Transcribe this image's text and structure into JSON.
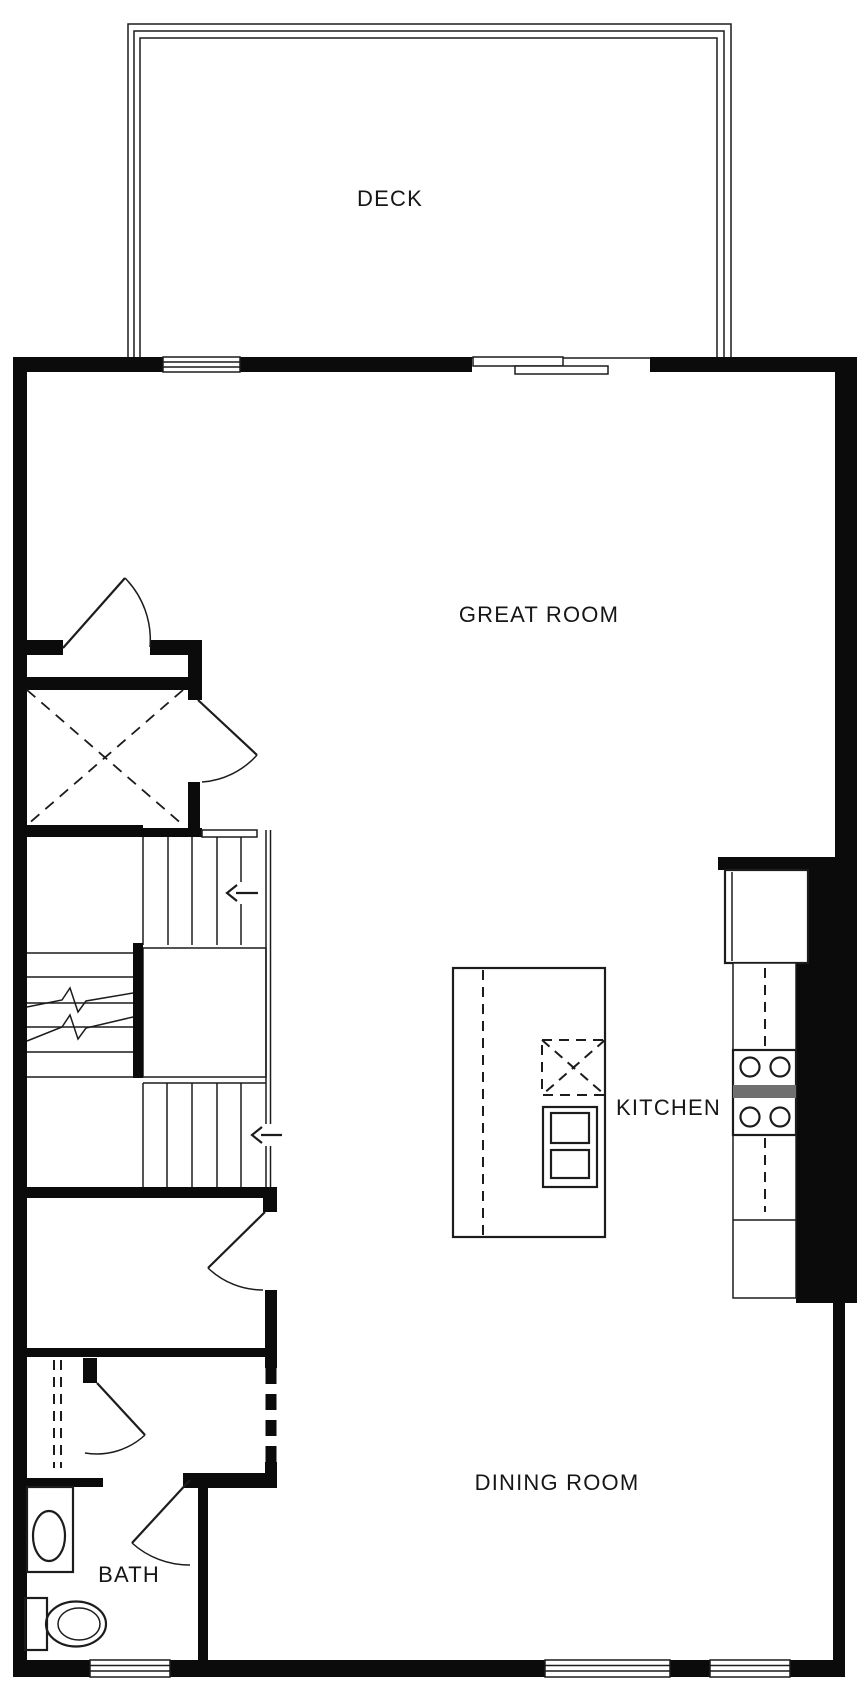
{
  "canvas": {
    "width": 860,
    "height": 1706,
    "background": "#ffffff"
  },
  "colors": {
    "walls": "#0b0b0b",
    "lines": "#1c1c1c",
    "range_band": "#6f6f6f",
    "background": "#ffffff"
  },
  "labels": {
    "deck": "DECK",
    "great_room": "GREAT ROOM",
    "kitchen": "KITCHEN",
    "dining_room": "DINING ROOM",
    "bath": "BATH"
  },
  "fixtures": [
    "deck-railing",
    "window",
    "sliding-glass-door",
    "entry-door-swing",
    "coat-closet-x",
    "stairs-upper-run",
    "stairs-lower-run",
    "stairs-left-run-with-break-lines",
    "stair-direction-arrow-left",
    "kitchen-island",
    "island-dashed-overhang",
    "island-x-fixture",
    "island-double-appliance",
    "refrigerator",
    "range-cooktop-4-burners",
    "counter-dashed-centerline",
    "hall-door-swing",
    "dashed-cased-opening",
    "linen-closet-dashed",
    "bath-door-swing",
    "vanity-with-oval-sink",
    "toilet"
  ],
  "stairs": {
    "arrow_count": 2,
    "arrow_direction": "left"
  }
}
